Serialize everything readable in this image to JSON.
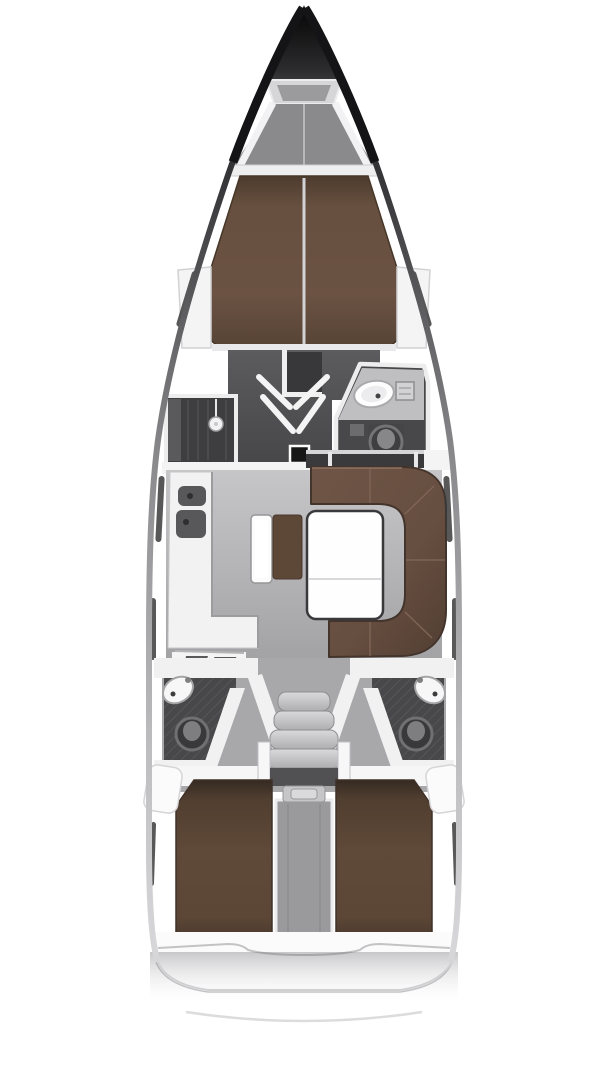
{
  "meta": {
    "diagram_kind": "sailing-yacht-deck-plan",
    "orientation": "bow-up",
    "cabins": 3,
    "heads": 3
  },
  "colors": {
    "background": "#ffffff",
    "hull_edge_dark": "#1a1a1c",
    "deck_white": "#f2f2f3",
    "foredeck_gray": "#88888b",
    "berth_forward": "#6a5243",
    "berth_aft": "#5e4737",
    "sofa_brown": "#6b5244",
    "bench_brown": "#5d4737",
    "saloon_floor": "#aeaeb1",
    "forward_floor": "#505053",
    "shower_floor": "#3e3e40",
    "head_floor": "#48484a",
    "locker_dark": "#3a3a3d",
    "step_gray": "#c9c9cb",
    "hatch_black": "#161616",
    "column_gray": "#9a9a9d"
  },
  "regions": [
    {
      "id": "bow",
      "role": "anchor-locker"
    },
    {
      "id": "foredeck",
      "role": "deck"
    },
    {
      "id": "v-berth-cabin",
      "role": "owner-cabin-forward"
    },
    {
      "id": "wardrobe-port",
      "role": "storage"
    },
    {
      "id": "wardrobe-starboard",
      "role": "storage"
    },
    {
      "id": "forward-cabin-floor",
      "role": "cabin-floor"
    },
    {
      "id": "shower-room",
      "role": "wet-room"
    },
    {
      "id": "head-forward",
      "role": "bathroom"
    },
    {
      "id": "saloon",
      "role": "living-area"
    },
    {
      "id": "galley",
      "role": "kitchen"
    },
    {
      "id": "nav-station",
      "role": "chart-table"
    },
    {
      "id": "settee-bench",
      "role": "seat"
    },
    {
      "id": "saloon-table",
      "role": "table"
    },
    {
      "id": "sofa-l-shaped",
      "role": "seating"
    },
    {
      "id": "companionway-stairs",
      "role": "stairs"
    },
    {
      "id": "head-aft-port",
      "role": "bathroom"
    },
    {
      "id": "head-aft-starboard",
      "role": "bathroom"
    },
    {
      "id": "engine-compartment",
      "role": "technical"
    },
    {
      "id": "aft-cabin-port",
      "role": "double-cabin"
    },
    {
      "id": "aft-cabin-starboard",
      "role": "double-cabin"
    },
    {
      "id": "transom",
      "role": "stern"
    },
    {
      "id": "swim-platform",
      "role": "stern-deck"
    }
  ]
}
